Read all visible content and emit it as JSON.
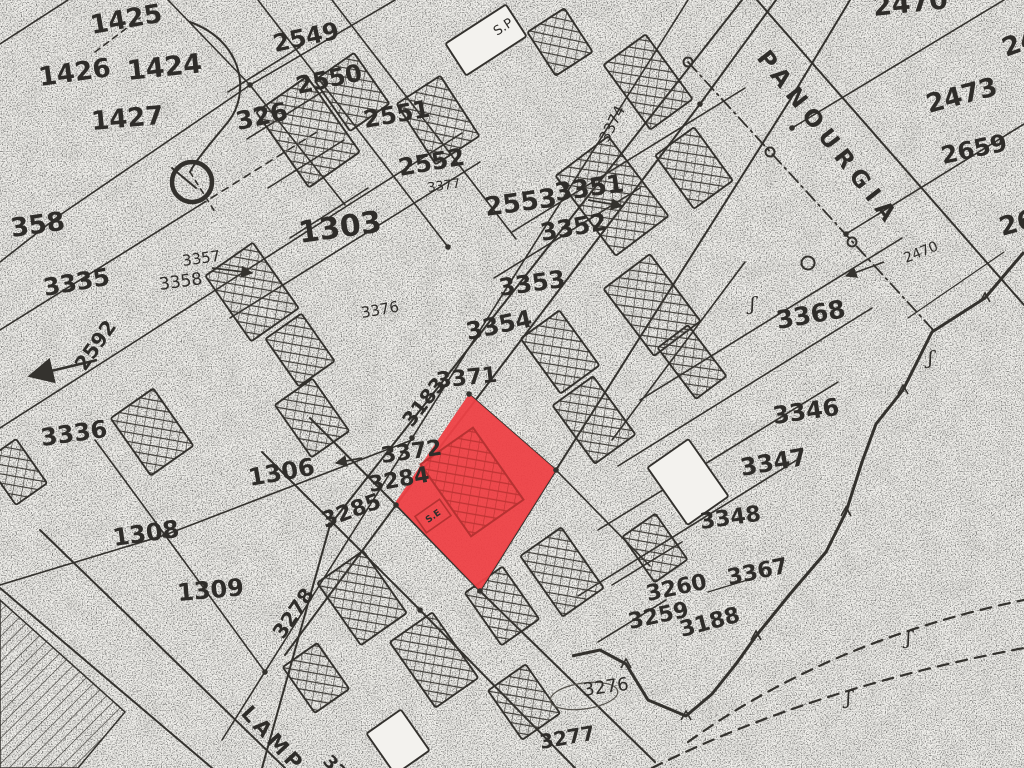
{
  "palette": {
    "paper": "#f3f2ee",
    "ink": "#34322e",
    "light_ink": "#55524c",
    "highlight_red": "#ee4146",
    "dark_red": "#b63232"
  },
  "highlight_parcel": {
    "points": "469,394 556,470 480,591 395,503",
    "interior_label": "S.E",
    "building": {
      "cx": 472,
      "cy": 482,
      "w": 64,
      "h": 88,
      "rot": -35
    },
    "label_box": {
      "cx": 433,
      "cy": 516,
      "w": 30,
      "h": 20,
      "rot": -35
    }
  },
  "street_labels": [
    {
      "text": "PANOURGIA",
      "x": 756,
      "y": 58,
      "rot": 52,
      "size": 23,
      "spacing": 7
    },
    {
      "text": "LAMP",
      "x": 240,
      "y": 714,
      "rot": 47,
      "size": 21,
      "spacing": 4
    }
  ],
  "parcel_labels": [
    {
      "t": "1425",
      "x": 92,
      "y": 34,
      "s": 26,
      "r": -10,
      "w": 700
    },
    {
      "t": "1426",
      "x": 40,
      "y": 86,
      "s": 26,
      "r": -8,
      "w": 700
    },
    {
      "t": "1424",
      "x": 128,
      "y": 80,
      "s": 27,
      "r": -6,
      "w": 700
    },
    {
      "t": "1427",
      "x": 92,
      "y": 130,
      "s": 26,
      "r": -5,
      "w": 700
    },
    {
      "t": "326",
      "x": 238,
      "y": 130,
      "s": 25,
      "r": -12,
      "w": 700
    },
    {
      "t": "2549",
      "x": 275,
      "y": 52,
      "s": 24,
      "r": -12,
      "w": 700
    },
    {
      "t": "2550",
      "x": 298,
      "y": 94,
      "s": 24,
      "r": -12,
      "w": 700
    },
    {
      "t": "2551",
      "x": 365,
      "y": 128,
      "s": 24,
      "r": -10,
      "w": 700
    },
    {
      "t": "2552",
      "x": 400,
      "y": 176,
      "s": 24,
      "r": -10,
      "w": 700
    },
    {
      "t": "2553",
      "x": 486,
      "y": 216,
      "s": 26,
      "r": -8,
      "w": 700
    },
    {
      "t": "3377",
      "x": 428,
      "y": 192,
      "s": 13,
      "r": -8,
      "w": 400
    },
    {
      "t": "3351",
      "x": 556,
      "y": 201,
      "s": 25,
      "r": -8,
      "w": 700
    },
    {
      "t": "3352",
      "x": 542,
      "y": 241,
      "s": 24,
      "r": -10,
      "w": 700
    },
    {
      "t": "3353",
      "x": 500,
      "y": 296,
      "s": 24,
      "r": -8,
      "w": 700
    },
    {
      "t": "3354",
      "x": 468,
      "y": 340,
      "s": 24,
      "r": -12,
      "w": 700
    },
    {
      "t": "3371",
      "x": 437,
      "y": 388,
      "s": 22,
      "r": -6,
      "w": 700
    },
    {
      "t": "3183",
      "x": 412,
      "y": 428,
      "s": 20,
      "r": -52,
      "w": 700
    },
    {
      "t": "3372",
      "x": 382,
      "y": 463,
      "s": 22,
      "r": -8,
      "w": 700
    },
    {
      "t": "3284",
      "x": 370,
      "y": 492,
      "s": 22,
      "r": -10,
      "w": 700
    },
    {
      "t": "3285",
      "x": 325,
      "y": 528,
      "s": 22,
      "r": -20,
      "w": 700
    },
    {
      "t": "3376",
      "x": 362,
      "y": 318,
      "s": 15,
      "r": -10,
      "w": 400
    },
    {
      "t": "1303",
      "x": 300,
      "y": 243,
      "s": 30,
      "r": -8,
      "w": 700
    },
    {
      "t": "3357",
      "x": 183,
      "y": 266,
      "s": 15,
      "r": -8,
      "w": 400
    },
    {
      "t": "3358",
      "x": 160,
      "y": 290,
      "s": 17,
      "r": -8,
      "w": 400
    },
    {
      "t": "3335",
      "x": 45,
      "y": 296,
      "s": 24,
      "r": -10,
      "w": 700
    },
    {
      "t": "2592",
      "x": 85,
      "y": 372,
      "s": 20,
      "r": -55,
      "w": 700
    },
    {
      "t": "3336",
      "x": 42,
      "y": 446,
      "s": 24,
      "r": -8,
      "w": 700
    },
    {
      "t": "1306",
      "x": 250,
      "y": 486,
      "s": 24,
      "r": -10,
      "w": 700
    },
    {
      "t": "1308",
      "x": 114,
      "y": 546,
      "s": 24,
      "r": -8,
      "w": 700
    },
    {
      "t": "1309",
      "x": 178,
      "y": 601,
      "s": 24,
      "r": -5,
      "w": 700
    },
    {
      "t": "3278",
      "x": 283,
      "y": 640,
      "s": 20,
      "r": -55,
      "w": 700
    },
    {
      "t": "358",
      "x": 12,
      "y": 237,
      "s": 26,
      "r": -8,
      "w": 700
    },
    {
      "t": "2470",
      "x": 874,
      "y": 16,
      "s": 27,
      "r": -6,
      "w": 700
    },
    {
      "t": "2473",
      "x": 929,
      "y": 113,
      "s": 26,
      "r": -15,
      "w": 700
    },
    {
      "t": "2473",
      "x": 1006,
      "y": 57,
      "s": 26,
      "r": -20,
      "w": 700
    },
    {
      "t": "2659",
      "x": 943,
      "y": 164,
      "s": 24,
      "r": -12,
      "w": 700
    },
    {
      "t": "265",
      "x": 1002,
      "y": 236,
      "s": 26,
      "r": -15,
      "w": 700
    },
    {
      "t": "2470",
      "x": 906,
      "y": 263,
      "s": 14,
      "r": -22,
      "w": 400
    },
    {
      "t": "3368",
      "x": 778,
      "y": 329,
      "s": 25,
      "r": -10,
      "w": 700
    },
    {
      "t": "3346",
      "x": 774,
      "y": 424,
      "s": 24,
      "r": -8,
      "w": 700
    },
    {
      "t": "3347",
      "x": 742,
      "y": 476,
      "s": 24,
      "r": -10,
      "w": 700
    },
    {
      "t": "3348",
      "x": 701,
      "y": 529,
      "s": 22,
      "r": -8,
      "w": 700
    },
    {
      "t": "3367",
      "x": 729,
      "y": 585,
      "s": 22,
      "r": -12,
      "w": 700
    },
    {
      "t": "3188",
      "x": 682,
      "y": 637,
      "s": 22,
      "r": -15,
      "w": 700
    },
    {
      "t": "3260",
      "x": 648,
      "y": 601,
      "s": 22,
      "r": -12,
      "w": 700
    },
    {
      "t": "3259",
      "x": 630,
      "y": 629,
      "s": 22,
      "r": -12,
      "w": 700
    },
    {
      "t": "3276",
      "x": 584,
      "y": 696,
      "s": 18,
      "r": -8,
      "w": 400
    },
    {
      "t": "3277",
      "x": 541,
      "y": 749,
      "s": 20,
      "r": -10,
      "w": 700
    },
    {
      "t": "3374",
      "x": 608,
      "y": 143,
      "s": 15,
      "r": -63,
      "w": 400
    },
    {
      "t": "S.P",
      "x": 497,
      "y": 36,
      "s": 13,
      "r": -33,
      "w": 400
    },
    {
      "t": "33",
      "x": 322,
      "y": 762,
      "s": 18,
      "r": 47,
      "w": 700
    }
  ],
  "lines": [
    {
      "p": [
        [
          0,
          44
        ],
        [
          68,
          0
        ]
      ]
    },
    {
      "p": [
        [
          60,
          215
        ],
        [
          250,
          85
        ],
        [
          395,
          0
        ]
      ]
    },
    {
      "p": [
        [
          168,
          0
        ],
        [
          250,
          85
        ],
        [
          345,
          205
        ]
      ]
    },
    {
      "p": [
        [
          0,
          262
        ],
        [
          60,
          215
        ]
      ]
    },
    {
      "p": [
        [
          0,
          330
        ],
        [
          200,
          205
        ]
      ]
    },
    {
      "p": [
        [
          200,
          205
        ],
        [
          320,
          130
        ]
      ],
      "d": "7,6"
    },
    {
      "p": [
        [
          0,
          428
        ],
        [
          350,
          204
        ],
        [
          462,
          133
        ]
      ]
    },
    {
      "p": [
        [
          230,
          318
        ],
        [
          480,
          162
        ]
      ]
    },
    {
      "p": [
        [
          0,
          585
        ],
        [
          165,
          535
        ],
        [
          412,
          440
        ]
      ]
    },
    {
      "p": [
        [
          95,
          440
        ],
        [
          165,
          535
        ],
        [
          265,
          672
        ]
      ]
    },
    {
      "p": [
        [
          40,
          530
        ],
        [
          285,
          768
        ]
      ],
      "w": 2
    },
    {
      "p": [
        [
          0,
          588
        ],
        [
          212,
          768
        ]
      ],
      "w": 2
    },
    {
      "p": [
        [
          222,
          740
        ],
        [
          688,
          0
        ]
      ]
    },
    {
      "p": [
        [
          262,
          768
        ],
        [
          330,
          525
        ],
        [
          742,
          0
        ]
      ],
      "w": 2
    },
    {
      "p": [
        [
          285,
          655
        ],
        [
          396,
          505
        ],
        [
          700,
          104
        ],
        [
          776,
          0
        ]
      ],
      "w": 2
    },
    {
      "p": [
        [
          310,
          418
        ],
        [
          396,
          505
        ],
        [
          480,
          591
        ],
        [
          655,
          762
        ]
      ],
      "w": 2
    },
    {
      "p": [
        [
          262,
          452
        ],
        [
          420,
          610
        ],
        [
          575,
          768
        ]
      ],
      "w": 2
    },
    {
      "p": [
        [
          469,
          394
        ],
        [
          556,
          470
        ],
        [
          650,
          566
        ]
      ]
    },
    {
      "p": [
        [
          480,
          591
        ],
        [
          556,
          470
        ],
        [
          790,
          100
        ],
        [
          850,
          0
        ]
      ],
      "w": 2
    },
    {
      "p": [
        [
          640,
          400
        ],
        [
          902,
          238
        ]
      ]
    },
    {
      "p": [
        [
          618,
          466
        ],
        [
          872,
          308
        ]
      ]
    },
    {
      "p": [
        [
          598,
          530
        ],
        [
          838,
          382
        ]
      ]
    },
    {
      "p": [
        [
          578,
          596
        ],
        [
          800,
          458
        ]
      ]
    },
    {
      "p": [
        [
          258,
          0
        ],
        [
          448,
          247
        ]
      ]
    },
    {
      "p": [
        [
          332,
          0
        ],
        [
          516,
          239
        ]
      ]
    },
    {
      "p": [
        [
          228,
          92
        ],
        [
          300,
          47
        ]
      ]
    },
    {
      "p": [
        [
          247,
          139
        ],
        [
          322,
          92
        ]
      ]
    },
    {
      "p": [
        [
          268,
          188
        ],
        [
          344,
          140
        ]
      ]
    },
    {
      "p": [
        [
          290,
          238
        ],
        [
          368,
          188
        ]
      ]
    },
    {
      "p": [
        [
          512,
          232
        ],
        [
          745,
          88
        ]
      ]
    },
    {
      "p": [
        [
          494,
          278
        ],
        [
          640,
          188
        ]
      ]
    },
    {
      "p": [
        [
          757,
          0
        ],
        [
          1024,
          305
        ]
      ],
      "w": 2
    },
    {
      "p": [
        [
          792,
          128
        ],
        [
          1004,
          0
        ]
      ]
    },
    {
      "p": [
        [
          846,
          234
        ],
        [
          1024,
          124
        ]
      ]
    },
    {
      "p": [
        [
          612,
          440
        ],
        [
          745,
          262
        ]
      ]
    },
    {
      "p": [
        [
          612,
          585
        ],
        [
          682,
          542
        ]
      ]
    },
    {
      "p": [
        [
          598,
          642
        ],
        [
          666,
          600
        ]
      ]
    },
    {
      "p": [
        [
          708,
          592
        ],
        [
          754,
          578
        ]
      ],
      "w": 1.4
    },
    {
      "p": [
        [
          95,
          52
        ],
        [
          140,
          18
        ]
      ],
      "d": "6,5"
    },
    {
      "p": [
        [
          190,
          172
        ],
        [
          215,
          212
        ]
      ],
      "d": "5,5"
    },
    {
      "p": [
        [
          908,
          318
        ],
        [
          1004,
          252
        ]
      ],
      "w": 1.2
    },
    {
      "p": [
        [
          688,
          62
        ],
        [
          935,
          332
        ]
      ],
      "d": "13,5,2,5",
      "w": 1.8
    },
    {
      "p": [
        [
          172,
          168
        ],
        [
          196,
          188
        ]
      ],
      "w": 2
    }
  ],
  "dashed_curves": [
    "M688,742 Q830,640 1024,600",
    "M652,768 Q812,688 1024,648"
  ],
  "curve_326": "M190,22 C245,42 250,95 228,122 C210,144 196,160 190,172",
  "wall": {
    "points": [
      [
        1024,
        252
      ],
      [
        985,
        298
      ],
      [
        932,
        332
      ],
      [
        903,
        390
      ],
      [
        876,
        424
      ],
      [
        862,
        462
      ],
      [
        846,
        512
      ],
      [
        826,
        552
      ],
      [
        790,
        594
      ],
      [
        756,
        636
      ],
      [
        736,
        664
      ],
      [
        712,
        694
      ],
      [
        686,
        716
      ],
      [
        648,
        700
      ],
      [
        626,
        664
      ],
      [
        600,
        650
      ],
      [
        572,
        656
      ]
    ],
    "ticks": [
      [
        985,
        298
      ],
      [
        903,
        390
      ],
      [
        846,
        512
      ],
      [
        756,
        636
      ],
      [
        686,
        716
      ],
      [
        626,
        664
      ]
    ]
  },
  "survey_circle": {
    "cx": 192,
    "cy": 182,
    "r": 20
  },
  "poles": [
    {
      "cx": 688,
      "cy": 62,
      "r": 4.5
    },
    {
      "cx": 770,
      "cy": 152,
      "r": 4.5
    },
    {
      "cx": 852,
      "cy": 242,
      "r": 4.5
    },
    {
      "cx": 808,
      "cy": 263,
      "r": 6.5
    }
  ],
  "section_marks": [
    {
      "x": 750,
      "y": 310
    },
    {
      "x": 928,
      "y": 364
    },
    {
      "x": 906,
      "y": 644
    },
    {
      "x": 846,
      "y": 704
    }
  ],
  "vertex_dots": [
    [
      250,
      85
    ],
    [
      396,
      505
    ],
    [
      469,
      394
    ],
    [
      556,
      470
    ],
    [
      480,
      591
    ],
    [
      330,
      525
    ],
    [
      165,
      535
    ],
    [
      792,
      128
    ],
    [
      846,
      234
    ],
    [
      700,
      104
    ],
    [
      412,
      438
    ],
    [
      448,
      247
    ],
    [
      265,
      672
    ],
    [
      420,
      610
    ]
  ],
  "arrows": [
    {
      "p": [
        [
          212,
          268
        ],
        [
          252,
          273
        ]
      ],
      "big": false
    },
    {
      "p": [
        [
          884,
          262
        ],
        [
          846,
          276
        ]
      ],
      "big": false
    },
    {
      "p": [
        [
          97,
          360
        ],
        [
          30,
          376
        ]
      ],
      "big": true
    },
    {
      "p": [
        [
          588,
          200
        ],
        [
          622,
          206
        ]
      ],
      "big": false
    },
    {
      "p": [
        [
          362,
          458
        ],
        [
          336,
          463
        ]
      ],
      "big": false
    }
  ],
  "buildings": [
    {
      "cx": 308,
      "cy": 132,
      "w": 62,
      "h": 92,
      "rot": -35,
      "type": "xh"
    },
    {
      "cx": 352,
      "cy": 92,
      "w": 48,
      "h": 62,
      "rot": -35,
      "type": "xh"
    },
    {
      "cx": 438,
      "cy": 120,
      "w": 52,
      "h": 72,
      "rot": -33,
      "type": "xh"
    },
    {
      "cx": 486,
      "cy": 40,
      "w": 72,
      "h": 38,
      "rot": -33,
      "type": "ol"
    },
    {
      "cx": 560,
      "cy": 42,
      "w": 44,
      "h": 52,
      "rot": -33,
      "type": "xh"
    },
    {
      "cx": 648,
      "cy": 82,
      "w": 52,
      "h": 80,
      "rot": -36,
      "type": "xh"
    },
    {
      "cx": 694,
      "cy": 168,
      "w": 48,
      "h": 66,
      "rot": -36,
      "type": "xh"
    },
    {
      "cx": 612,
      "cy": 196,
      "w": 66,
      "h": 100,
      "rot": -37,
      "type": "xh"
    },
    {
      "cx": 652,
      "cy": 305,
      "w": 58,
      "h": 84,
      "rot": -37,
      "type": "xh"
    },
    {
      "cx": 560,
      "cy": 352,
      "w": 48,
      "h": 68,
      "rot": -36,
      "type": "xh"
    },
    {
      "cx": 594,
      "cy": 420,
      "w": 50,
      "h": 72,
      "rot": -36,
      "type": "xh"
    },
    {
      "cx": 252,
      "cy": 292,
      "w": 58,
      "h": 80,
      "rot": -35,
      "type": "xh"
    },
    {
      "cx": 300,
      "cy": 350,
      "w": 44,
      "h": 58,
      "rot": -35,
      "type": "xh"
    },
    {
      "cx": 152,
      "cy": 432,
      "w": 52,
      "h": 70,
      "rot": -35,
      "type": "xh"
    },
    {
      "cx": 312,
      "cy": 418,
      "w": 46,
      "h": 64,
      "rot": -35,
      "type": "xh"
    },
    {
      "cx": 692,
      "cy": 362,
      "w": 38,
      "h": 64,
      "rot": -37,
      "type": "xh"
    },
    {
      "cx": 362,
      "cy": 598,
      "w": 56,
      "h": 76,
      "rot": -35,
      "type": "xh"
    },
    {
      "cx": 434,
      "cy": 660,
      "w": 52,
      "h": 80,
      "rot": -35,
      "type": "xh"
    },
    {
      "cx": 502,
      "cy": 606,
      "w": 46,
      "h": 64,
      "rot": -35,
      "type": "xh"
    },
    {
      "cx": 316,
      "cy": 678,
      "w": 42,
      "h": 56,
      "rot": -35,
      "type": "xh"
    },
    {
      "cx": 524,
      "cy": 702,
      "w": 46,
      "h": 60,
      "rot": -35,
      "type": "xh"
    },
    {
      "cx": 398,
      "cy": 742,
      "w": 42,
      "h": 50,
      "rot": -35,
      "type": "ol"
    },
    {
      "cx": 562,
      "cy": 572,
      "w": 50,
      "h": 74,
      "rot": -35,
      "type": "xh"
    },
    {
      "cx": 655,
      "cy": 548,
      "w": 40,
      "h": 56,
      "rot": -35,
      "type": "xh"
    },
    {
      "cx": 16,
      "cy": 472,
      "w": 38,
      "h": 54,
      "rot": -35,
      "type": "xh"
    },
    {
      "cx": 688,
      "cy": 482,
      "w": 50,
      "h": 70,
      "rot": -35,
      "type": "ol"
    }
  ],
  "diagonal_hatch_area": "0,600 125,712 78,768 0,768",
  "oval_3276": {
    "cx": 584,
    "cy": 696,
    "rx": 34,
    "ry": 13,
    "rot": -8
  }
}
